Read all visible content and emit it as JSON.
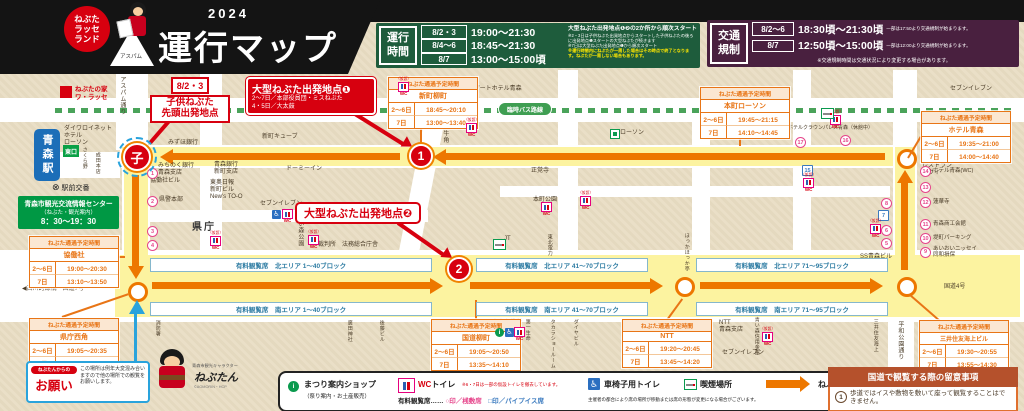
{
  "colors": {
    "accent_red": "#d7000f",
    "route_orange": "#ed7700",
    "route_yellow": "#fcf3a0",
    "schedule_green": "#1e5c3c",
    "traffic_purple": "#49203f",
    "bus_green": "#4aa35a",
    "table_orange": "#e87516",
    "seat_blue": "#2e7ca3",
    "kodomo_blue": "#29a3dc"
  },
  "header": {
    "badge": "ねぶた\nラッセ\nランド",
    "aspam_label": "アスパム",
    "year": "2024",
    "title": "運行マップ"
  },
  "schedule_box": {
    "label": "運行\n時間",
    "rows": [
      {
        "date": "8/2・3",
        "time": "19:00〜21:30"
      },
      {
        "date": "8/4〜6",
        "time": "18:45〜21:30"
      },
      {
        "date": "8/7",
        "time": "13:00〜15:00頃"
      }
    ],
    "note_main": "大型ねぶた出発地点❶❷の2か所から順次スタート",
    "notes": [
      "※2・3日は子供ねぶた出発地点からスタートした子供ねぶたの後ろに出発地点❶スタートの大型ねぶたが続きます",
      "※7日は大型ねぶた出発地点❶から順次スタート"
    ],
    "note_warning": "※運行時間内にねぶたが一周した場合はその時点で終了となります。ねぶたが一周しない場合もあります。"
  },
  "traffic_box": {
    "label": "交通\n規制",
    "rows": [
      {
        "date": "8/2〜6",
        "time": "18:30頃〜21:30頃",
        "note": "一部は17:50より交通規制が始まります。"
      },
      {
        "date": "8/7",
        "time": "12:50頃〜15:00頃",
        "note": "一部は12:00より交通規制が始まります。"
      }
    ],
    "note": "※交通規制時間は交通状況により変更する場合があります。"
  },
  "map": {
    "warasse": "ねぶたの家\nワ・ラッセ",
    "bus_route_label": "臨時バス路線",
    "station": {
      "name": "青森駅",
      "east_exit": "東口",
      "koban": "駅前交番"
    },
    "info_center": {
      "name": "青森市観光交流情報センター",
      "sub": "（ねぶた・観光案内）",
      "hours": "8：30〜19：30"
    },
    "markers": {
      "kodomo": "子",
      "start1": "1",
      "start2": "2"
    },
    "callouts": {
      "kodomo": {
        "date": "8/2・3",
        "lines": "子供ねぶた\n先頭出発地点"
      },
      "start1": {
        "title": "大型ねぶた出発地点❶",
        "line1": "2〜7日／本部役員団・ミスねぶた",
        "line2": "4・5日／大太鼓"
      },
      "start2": {
        "title": "大型ねぶた出発地点❷"
      }
    },
    "onegai": {
      "badge": "ねぶたんからの",
      "title": "お願い",
      "text": "この場所は例年大変混み合いますので他の場所での観覧をお願いします。"
    },
    "nebutan": {
      "caption": "青森市観光キャラクター",
      "name": "ねぶたん",
      "copyright": "©AOMORIN・HCP"
    },
    "pass_header": "ねぶた通過予定時間",
    "wc_kari_label": "（仮設）",
    "wc_text": "WC",
    "pass_tables": [
      {
        "place": "協働社",
        "x": 29,
        "y": 236,
        "rows": [
          [
            "2〜6日",
            "19:00〜20:30"
          ],
          [
            "7日",
            "13:10〜13:50"
          ]
        ]
      },
      {
        "place": "県庁西角",
        "x": 29,
        "y": 318,
        "rows": [
          [
            "2〜6日",
            "19:05〜20:35"
          ],
          [
            "7日",
            "13:20〜14:00"
          ]
        ]
      },
      {
        "place": "新町柳町",
        "x": 388,
        "y": 77,
        "rows": [
          [
            "2〜6日",
            "18:45〜20:10"
          ],
          [
            "7日",
            "13:00〜13:40"
          ]
        ]
      },
      {
        "place": "本町ローソン",
        "x": 700,
        "y": 87,
        "rows": [
          [
            "2〜6日",
            "19:45〜21:15"
          ],
          [
            "7日",
            "14:10〜14:45"
          ]
        ]
      },
      {
        "place": "ホテル青森",
        "x": 921,
        "y": 111,
        "rows": [
          [
            "2〜6日",
            "19:35〜21:00"
          ],
          [
            "7日",
            "14:00〜14:40"
          ]
        ]
      },
      {
        "place": "国道柳町",
        "x": 431,
        "y": 319,
        "rows": [
          [
            "2〜6日",
            "19:05〜20:50"
          ],
          [
            "7日",
            "13:35〜14:10"
          ]
        ]
      },
      {
        "place": "NTT",
        "x": 622,
        "y": 319,
        "rows": [
          [
            "2〜6日",
            "19:20〜20:45"
          ],
          [
            "7日",
            "13:45〜14:20"
          ]
        ]
      },
      {
        "place": "三井住友海上ビル",
        "x": 919,
        "y": 320,
        "rows": [
          [
            "2〜6日",
            "19:30〜20:55"
          ],
          [
            "7日",
            "13:55〜14:30"
          ]
        ]
      }
    ],
    "seat_labels": [
      {
        "t": "有料観覧席　北エリア 1〜40ブロック",
        "x": 150,
        "y": 258,
        "w": 280
      },
      {
        "t": "有料観覧席　南エリア 1〜40ブロック",
        "x": 150,
        "y": 302,
        "w": 280
      },
      {
        "t": "有料観覧席　北エリア 41〜70ブロック",
        "x": 476,
        "y": 258,
        "w": 170
      },
      {
        "t": "有料観覧席　南エリア 41〜70ブロック",
        "x": 476,
        "y": 302,
        "w": 170
      },
      {
        "t": "有料観覧席　北エリア 71〜95ブロック",
        "x": 696,
        "y": 258,
        "w": 190
      },
      {
        "t": "有料観覧席　南エリア 71〜95ブロック",
        "x": 696,
        "y": 302,
        "w": 190
      }
    ],
    "seat_numbers": [
      {
        "n": "1",
        "x": 147,
        "y": 168,
        "shape": "c"
      },
      {
        "n": "2",
        "x": 147,
        "y": 196,
        "shape": "c"
      },
      {
        "n": "3",
        "x": 147,
        "y": 226,
        "shape": "c"
      },
      {
        "n": "4",
        "x": 147,
        "y": 240,
        "shape": "c"
      },
      {
        "n": "5",
        "x": 881,
        "y": 238,
        "shape": "c"
      },
      {
        "n": "6",
        "x": 881,
        "y": 225,
        "shape": "c"
      },
      {
        "n": "7",
        "x": 878,
        "y": 210,
        "shape": "s"
      },
      {
        "n": "8",
        "x": 881,
        "y": 198,
        "shape": "c"
      },
      {
        "n": "9",
        "x": 920,
        "y": 246,
        "shape": "c",
        "label": "あいおいニッセイ\n同和損保"
      },
      {
        "n": "10",
        "x": 920,
        "y": 233,
        "shape": "c",
        "label": "堤町パーキング"
      },
      {
        "n": "11",
        "x": 920,
        "y": 219,
        "shape": "c",
        "label": "青森商工会館"
      },
      {
        "n": "12",
        "x": 920,
        "y": 197,
        "shape": "c",
        "label": "蓮華寺"
      },
      {
        "n": "13",
        "x": 920,
        "y": 182,
        "shape": "c"
      },
      {
        "n": "14",
        "x": 920,
        "y": 166,
        "shape": "c",
        "label": "ホテル青森(WC)"
      },
      {
        "n": "15",
        "x": 802,
        "y": 165,
        "shape": "s"
      },
      {
        "n": "16",
        "x": 840,
        "y": 135,
        "shape": "c"
      },
      {
        "n": "17",
        "x": 795,
        "y": 137,
        "shape": "c"
      }
    ],
    "wc_icons": [
      {
        "x": 208,
        "y": 232,
        "kari": 1
      },
      {
        "x": 282,
        "y": 209,
        "kari": 0
      },
      {
        "x": 306,
        "y": 231,
        "kari": 1
      },
      {
        "x": 396,
        "y": 78,
        "kari": 1
      },
      {
        "x": 464,
        "y": 119,
        "kari": 1
      },
      {
        "x": 578,
        "y": 192,
        "kari": 1
      },
      {
        "x": 541,
        "y": 202,
        "kari": 0
      },
      {
        "x": 828,
        "y": 111,
        "kari": 1
      },
      {
        "x": 801,
        "y": 174,
        "kari": 1
      },
      {
        "x": 868,
        "y": 220,
        "kari": 1
      },
      {
        "x": 760,
        "y": 328,
        "kari": 1
      },
      {
        "x": 514,
        "y": 327,
        "kari": 0
      }
    ],
    "lawson_icons": [
      {
        "x": 256,
        "y": 87
      },
      {
        "x": 610,
        "y": 129
      }
    ],
    "smoking_icons": [
      {
        "x": 493,
        "y": 239
      },
      {
        "x": 821,
        "y": 108
      }
    ],
    "info_icons": [
      {
        "x": 495,
        "y": 328
      }
    ],
    "wheelchair_icons": [
      {
        "x": 272,
        "y": 210
      },
      {
        "x": 505,
        "y": 328
      }
    ],
    "buildings": [
      {
        "t": "アスパム通り",
        "x": 118,
        "y": 76,
        "v": 1
      },
      {
        "t": "ダイワロイネット\nホテル\nローソン",
        "x": 64,
        "y": 126
      },
      {
        "t": "アパホテル",
        "x": 174,
        "y": 112
      },
      {
        "t": "みずほ銀行",
        "x": 168,
        "y": 140
      },
      {
        "t": "野村證券",
        "x": 246,
        "y": 82,
        "v": 1
      },
      {
        "t": "善知鳥神社",
        "x": 286,
        "y": 92
      },
      {
        "t": "新町キューブ",
        "x": 262,
        "y": 134
      },
      {
        "t": "ドーミーイン",
        "x": 286,
        "y": 166
      },
      {
        "t": "みちのく銀行\n青森支店",
        "x": 158,
        "y": 163
      },
      {
        "t": "協働社ビル",
        "x": 150,
        "y": 178
      },
      {
        "t": "青森銀行\n新町支店",
        "x": 214,
        "y": 162
      },
      {
        "t": "東奥日報\n新町ビル\nNew's TO-O",
        "x": 210,
        "y": 180
      },
      {
        "t": "県警本部",
        "x": 159,
        "y": 197
      },
      {
        "t": "県庁",
        "x": 192,
        "y": 222,
        "big": 1
      },
      {
        "t": "セブンイレブン",
        "x": 260,
        "y": 201
      },
      {
        "t": "青い森公園",
        "x": 296,
        "y": 214,
        "v": 1
      },
      {
        "t": "裁判所　法務総合庁舎",
        "x": 318,
        "y": 242
      },
      {
        "t": "さくら野",
        "x": 81,
        "y": 147,
        "v": 1,
        "sm": 1
      },
      {
        "t": "成田本店",
        "x": 94,
        "y": 152,
        "v": 1,
        "sm": 1
      },
      {
        "t": "◀古川跨線橋　国道7号",
        "x": 22,
        "y": 286
      },
      {
        "t": "消防署",
        "x": 154,
        "y": 320,
        "v": 1,
        "sm": 1
      },
      {
        "t": "廣田神社",
        "x": 346,
        "y": 320,
        "v": 1,
        "sm": 1
      },
      {
        "t": "後藤ビル",
        "x": 378,
        "y": 320,
        "v": 1,
        "sm": 1
      },
      {
        "t": "牛角",
        "x": 441,
        "y": 130,
        "v": 1
      },
      {
        "t": "アートホテル青森",
        "x": 474,
        "y": 86
      },
      {
        "t": "ローソン",
        "x": 620,
        "y": 130
      },
      {
        "t": "正覚寺",
        "x": 531,
        "y": 168
      },
      {
        "t": "本町公園",
        "x": 533,
        "y": 197
      },
      {
        "t": "JT",
        "x": 504,
        "y": 236
      },
      {
        "t": "東北電力",
        "x": 546,
        "y": 234,
        "v": 1,
        "sm": 1
      },
      {
        "t": "ホテルクラウンパレス青森（休館中）",
        "x": 788,
        "y": 126,
        "sm": 1
      },
      {
        "t": "レストラン\nラヴィ",
        "x": 922,
        "y": 163
      },
      {
        "t": "セブンイレブン",
        "x": 950,
        "y": 86
      },
      {
        "t": "青森市役所",
        "x": 492,
        "y": 320
      },
      {
        "t": "第一生命",
        "x": 524,
        "y": 319,
        "v": 1,
        "sm": 1
      },
      {
        "t": "タカラショールーム",
        "x": 549,
        "y": 319,
        "v": 1,
        "sm": 1
      },
      {
        "t": "ダイヤビル",
        "x": 572,
        "y": 319,
        "v": 1,
        "sm": 1
      },
      {
        "t": "ほっかほっか亭",
        "x": 683,
        "y": 233,
        "v": 1,
        "sm": 1
      },
      {
        "t": "NTT\n青森支店",
        "x": 719,
        "y": 320
      },
      {
        "t": "セブンイレブン",
        "x": 722,
        "y": 350
      },
      {
        "t": "青い森信用金庫",
        "x": 753,
        "y": 317,
        "v": 1,
        "sm": 1
      },
      {
        "t": "SS青森ビル",
        "x": 860,
        "y": 254
      },
      {
        "t": "三井住友海上",
        "x": 872,
        "y": 319,
        "v": 1,
        "sm": 1
      },
      {
        "t": "平和公園通り",
        "x": 896,
        "y": 321,
        "v": 1
      },
      {
        "t": "国道4号",
        "x": 944,
        "y": 284
      }
    ]
  },
  "legend": {
    "shop": "まつり案内ショップ",
    "shop_sub": "（祭り案内・お土産販売）",
    "wc_red": "WC",
    "wc_rest": "トイレ",
    "wc_note": "※6・7日は一部の仮設トイレを撤去しています。",
    "seats": "有料観覧席……",
    "seat_zashiki": "○印／桟敷席",
    "seat_pipe": "□印／パイプイス席",
    "wheelchair": "車椅子用トイレ",
    "smoking": "喫煙場所",
    "direction": "ねぶた運行方向",
    "note": "主催者の都合により席の場所が移動または席の形態が変更になる場合がございます。"
  },
  "notice": {
    "title": "国道で観覧する際の留意事項",
    "item_no": "1",
    "item": "歩道ではイスや敷物を敷いて座って観覧することはできません。"
  }
}
